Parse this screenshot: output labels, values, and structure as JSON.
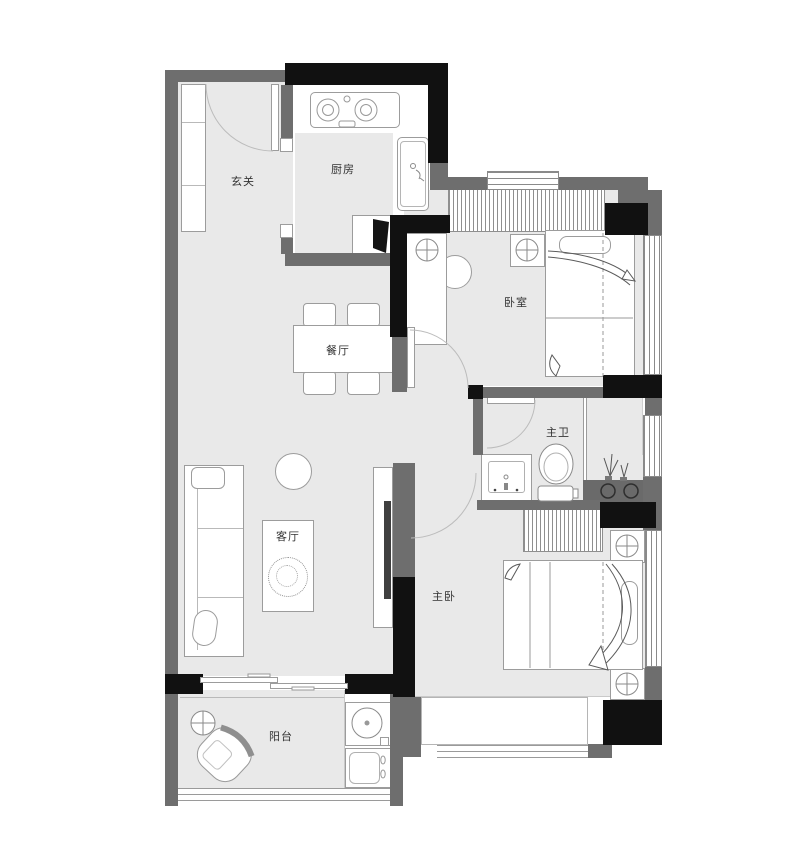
{
  "title": "two-bedroom apartment floor plan",
  "rooms": [
    {
      "name": "foyer",
      "label": "玄关"
    },
    {
      "name": "kitchen",
      "label": "厨房"
    },
    {
      "name": "dining-room",
      "label": "餐厅"
    },
    {
      "name": "bedroom",
      "label": "卧室"
    },
    {
      "name": "master-bathroom",
      "label": "主卫"
    },
    {
      "name": "living-room",
      "label": "客厅"
    },
    {
      "name": "master-bedroom",
      "label": "主卧"
    },
    {
      "name": "balcony",
      "label": "阳台"
    }
  ],
  "colors": {
    "wall_structural": "#111111",
    "wall_partition": "#6e6e6e",
    "floor": "#e9e9e9",
    "furniture_outline": "#9c9c9c",
    "background": "#ffffff"
  },
  "furniture": [
    "shoe-cabinet",
    "entry-door",
    "stove",
    "kitchen-sink",
    "fridge",
    "dining-table",
    "dining-chair",
    "round-stool",
    "sofa",
    "coffee-table",
    "tv-console",
    "tv",
    "wardrobe",
    "nightstand",
    "lamp",
    "bed",
    "desk",
    "desk-chair",
    "toilet",
    "bathroom-sink",
    "shower-glass",
    "plant",
    "washing-machine",
    "laundry-sink",
    "lounge-chair",
    "side-table",
    "sliding-door",
    "window",
    "bay-window",
    "railing"
  ]
}
